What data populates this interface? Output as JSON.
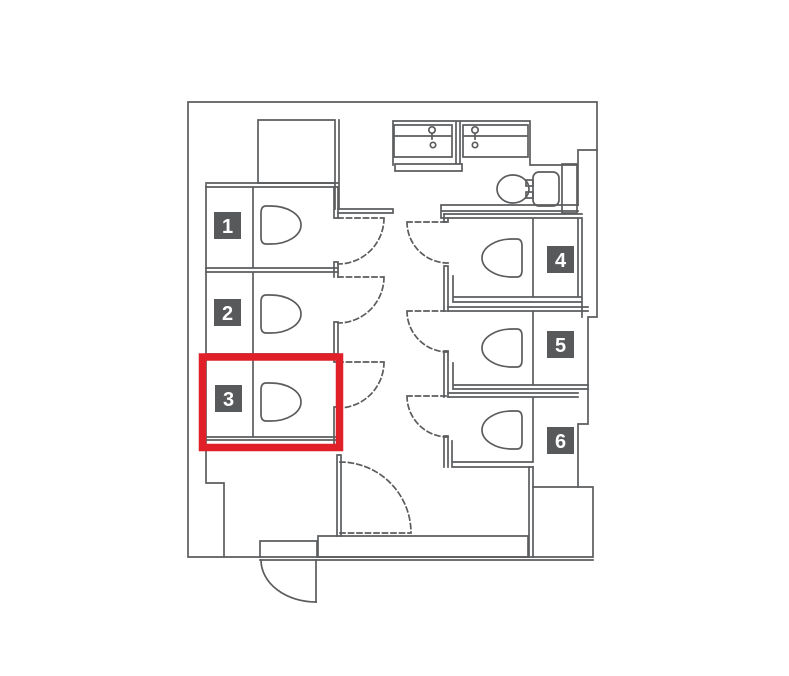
{
  "colors": {
    "background": "#ffffff",
    "wall": "#5b5c5e",
    "badge_bg": "#58595b",
    "badge_text": "#ffffff",
    "highlight": "#e01f29"
  },
  "stalls": [
    {
      "label": "1"
    },
    {
      "label": "2"
    },
    {
      "label": "3"
    },
    {
      "label": "4"
    },
    {
      "label": "5"
    },
    {
      "label": "6"
    }
  ],
  "selected_stall": "3"
}
